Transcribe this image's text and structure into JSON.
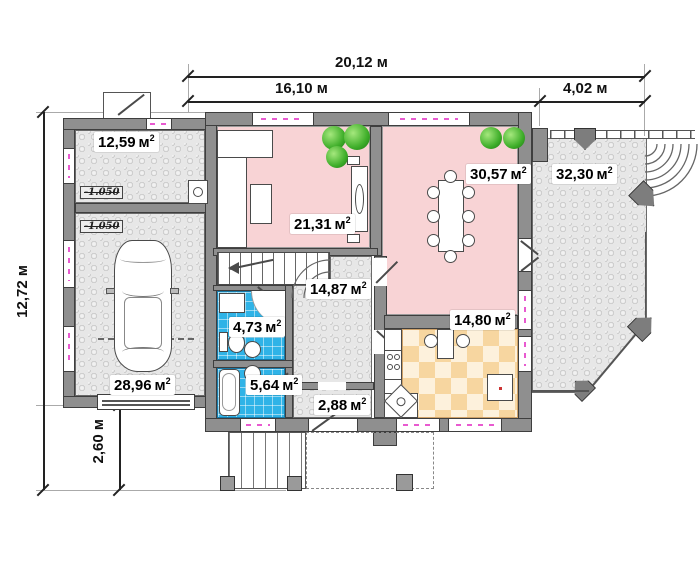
{
  "unit": "м",
  "unit_sup": "2",
  "dimensions": {
    "top_total": "20,12 м",
    "top_left": "16,10 м",
    "top_right": "4,02 м",
    "side_total": "12,72 м",
    "side_upper": "10,12 м",
    "side_lower": "2,60 м"
  },
  "rooms": {
    "storage": {
      "area": "12,59"
    },
    "garage": {
      "area": "28,96"
    },
    "living": {
      "area": "21,31"
    },
    "dining": {
      "area": "30,57"
    },
    "terrace": {
      "area": "32,30"
    },
    "hall": {
      "area": "14,87"
    },
    "wc": {
      "area": "4,73"
    },
    "bath": {
      "area": "5,64"
    },
    "vestibule": {
      "area": "2,88"
    },
    "kitchen": {
      "area": "14,80"
    }
  },
  "level_marks": {
    "storage": "-1.050",
    "garage": "-1.050"
  },
  "colors": {
    "wall": "#8f8f8f",
    "room_pink": "#f8d3d5",
    "tile_blue": "#2fb3e7",
    "paving_gray": "#e7e7e7",
    "kitchen_checker": "#f7d6a0",
    "window_accent_magenta": "#e85ad0",
    "plant_green": "#3fae2a"
  }
}
